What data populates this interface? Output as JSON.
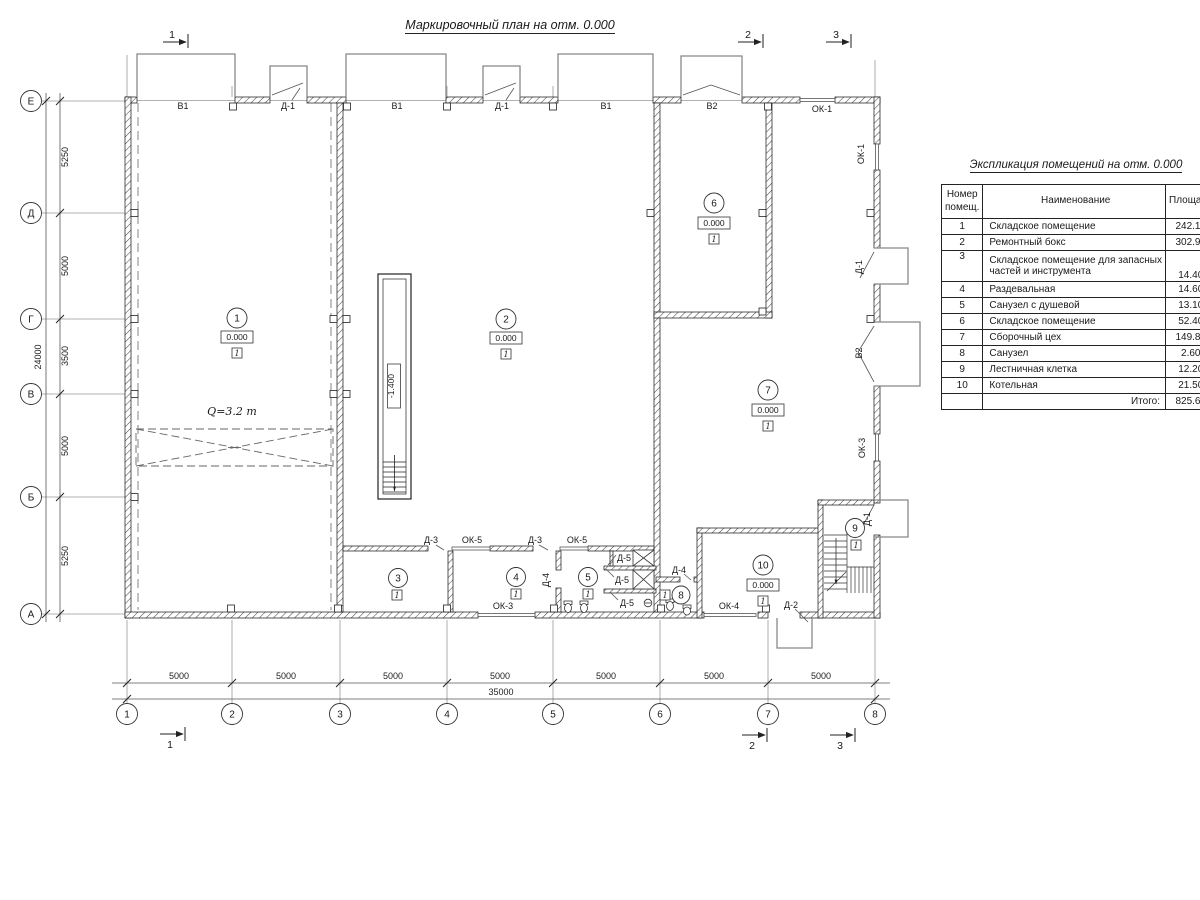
{
  "page_title": "Маркировочный план на отм. 0.000",
  "plan": {
    "grid": {
      "cols": [
        "1",
        "2",
        "3",
        "4",
        "5",
        "6",
        "7",
        "8"
      ],
      "rows": [
        "Е",
        "Д",
        "Г",
        "В",
        "Б",
        "А"
      ]
    },
    "dims": {
      "bottom": [
        "5000",
        "5000",
        "5000",
        "5000",
        "5000",
        "5000",
        "5000"
      ],
      "bottom_total": "35000",
      "left": [
        "5250",
        "5000",
        "3500",
        "5000",
        "5250"
      ],
      "left_total": "24000"
    },
    "sections": [
      "1",
      "2",
      "3"
    ],
    "rooms": {
      "r1": {
        "num": "1",
        "elev": "0.000",
        "floor": "1"
      },
      "r2": {
        "num": "2",
        "elev": "0.000",
        "floor": "1"
      },
      "r3": {
        "num": "3",
        "floor": "1"
      },
      "r4": {
        "num": "4",
        "floor": "1"
      },
      "r5": {
        "num": "5",
        "floor": "1"
      },
      "r6": {
        "num": "6",
        "elev": "0.000",
        "floor": "1"
      },
      "r7": {
        "num": "7",
        "elev": "0.000",
        "floor": "1"
      },
      "r8": {
        "num": "8",
        "floor": "1"
      },
      "r9": {
        "num": "9",
        "floor": "1"
      },
      "r10": {
        "num": "10",
        "elev": "0.000",
        "floor": "1"
      }
    },
    "openings": {
      "top": [
        "В1",
        "Д-1",
        "В1",
        "Д-1",
        "В1",
        "В2",
        "ОК-1"
      ],
      "right": [
        "ОК-1",
        "Д-1",
        "В2",
        "ОК-3",
        "Д-1"
      ],
      "bottom": [
        "ОК-3",
        "ОК-4",
        "Д-2"
      ],
      "interior": [
        "Д-3",
        "ОК-5",
        "Д-3",
        "ОК-5",
        "Д-4",
        "Д-5",
        "Д-5",
        "Д-5",
        "Д-4"
      ]
    },
    "crane_label": "Q=3.2 т",
    "pit_depth": "-1.400"
  },
  "explication": {
    "title": "Экспликация помещений на отм. 0.000",
    "header": {
      "num1": "Номер",
      "num2": "помещ.",
      "name": "Наименование",
      "area": "Площадь",
      "cat1": "Ка",
      "cat2": "по"
    },
    "rows": [
      {
        "num": "1",
        "name": "Складское помещение",
        "area": "242.10"
      },
      {
        "num": "2",
        "name": "Ремонтный бокс",
        "area": "302.90"
      },
      {
        "num": "3",
        "name": "Складское помещение для запасных",
        "name2": "частей и инструмента",
        "area": "14.40"
      },
      {
        "num": "4",
        "name": "Раздевальная",
        "area": "14.60"
      },
      {
        "num": "5",
        "name": "Санузел с душевой",
        "area": "13.10"
      },
      {
        "num": "6",
        "name": "Складское помещение",
        "area": "52.40"
      },
      {
        "num": "7",
        "name": "Сборочный цех",
        "area": "149.80"
      },
      {
        "num": "8",
        "name": "Санузел",
        "area": "2.60"
      },
      {
        "num": "9",
        "name": "Лестничная клетка",
        "area": "12.20"
      },
      {
        "num": "10",
        "name": "Котельная",
        "area": "21.50"
      }
    ],
    "total_label": "Итого:",
    "total_value": "825.60"
  }
}
